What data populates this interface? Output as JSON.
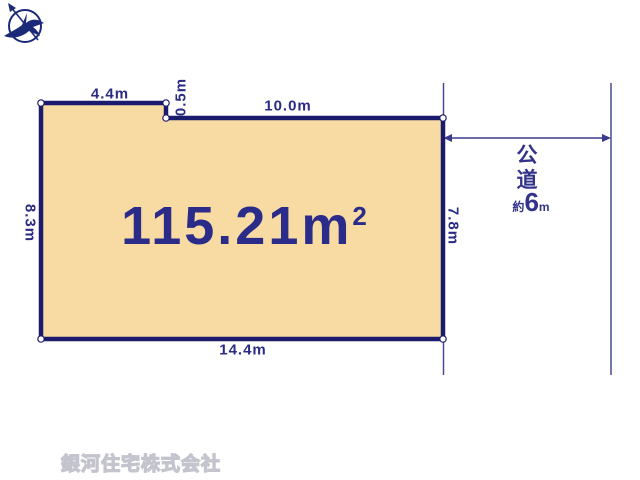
{
  "diagram_title": "land-plot-diagram",
  "plot": {
    "area_value": "115.21",
    "area_unit": "m",
    "area_exponent": "2",
    "dimensions": {
      "top_left_edge": "4.4m",
      "notch_edge": "0.5m",
      "top_right_edge": "10.0m",
      "left_edge": "8.3m",
      "right_edge": "7.8m",
      "bottom_edge": "14.4m"
    },
    "colors": {
      "plot_fill": "#F7DBA2",
      "outline": "#1B1B6E",
      "dimension_text": "#2B2B85",
      "thin_line": "#4A4A93",
      "watermark_text": "#C4C4CE"
    }
  },
  "road": {
    "name_chars": [
      "公",
      "道"
    ],
    "width_prefix": "約",
    "width_value": "6",
    "width_unit": "m"
  },
  "footer": {
    "company_name": "銀河住宅株式会社",
    "logo_icon": "compass-bird-logo"
  }
}
